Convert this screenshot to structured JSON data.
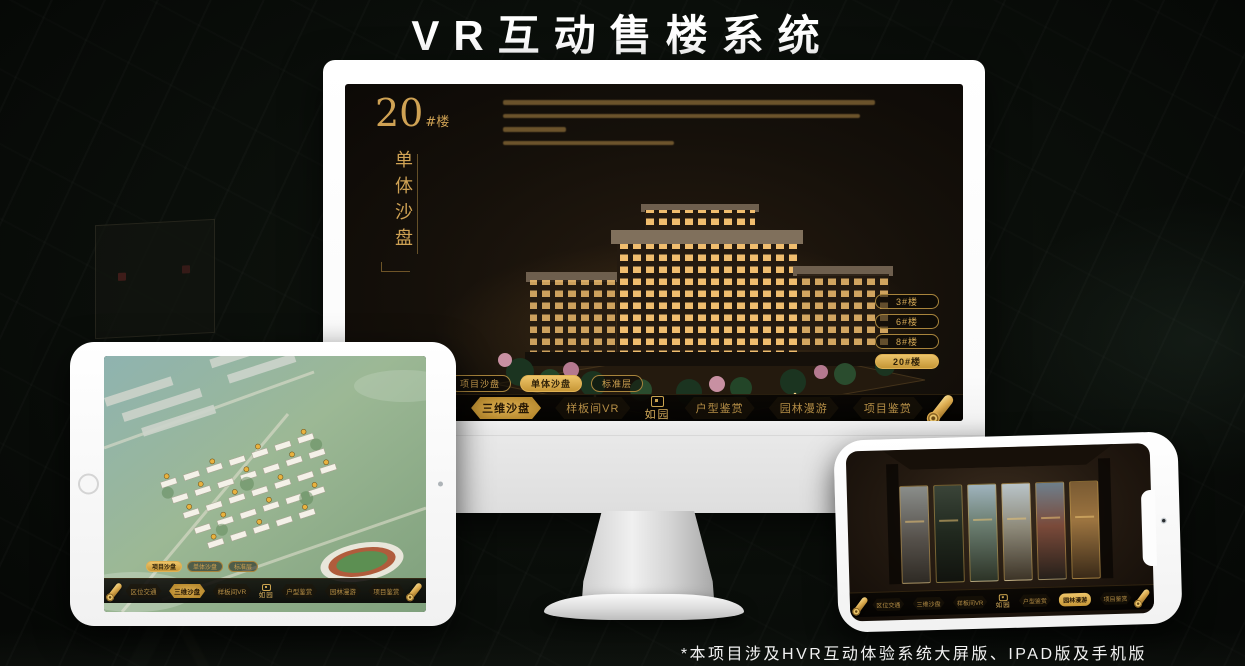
{
  "page": {
    "title": "VR互动售楼系统",
    "footnote": "*本项目涉及HVR互动体验系统大屏版、IPAD版及手机版"
  },
  "colors": {
    "accent_gold": "#c79a4b",
    "accent_gold_bright": "#e6be6a",
    "selected_pill_bg": "#d8a94e",
    "screen_background": "#171008",
    "title_text": "#ffffff"
  },
  "monitor": {
    "block": {
      "number": "20",
      "suffix": "#楼",
      "subtitle_vertical": "单体沙盘"
    },
    "building_buttons": [
      {
        "label": "3#楼",
        "selected": false
      },
      {
        "label": "6#楼",
        "selected": false
      },
      {
        "label": "8#楼",
        "selected": false
      },
      {
        "label": "20#楼",
        "selected": true
      }
    ]
  },
  "subtabs": {
    "items": [
      {
        "label": "项目沙盘"
      },
      {
        "label": "单体沙盘"
      },
      {
        "label": "标准层"
      }
    ],
    "selected_monitor": "单体沙盘",
    "selected_tablet": "项目沙盘"
  },
  "nav": {
    "items": [
      {
        "label": "区位交通"
      },
      {
        "label": "三维沙盘"
      },
      {
        "label": "样板间VR"
      },
      {
        "label": "户型鉴赏"
      },
      {
        "label": "园林漫游"
      },
      {
        "label": "项目鉴赏"
      }
    ],
    "logo_text": "如园",
    "selected_monitor": "三维沙盘",
    "selected_tablet": "三维沙盘",
    "selected_phone": "园林漫游"
  }
}
